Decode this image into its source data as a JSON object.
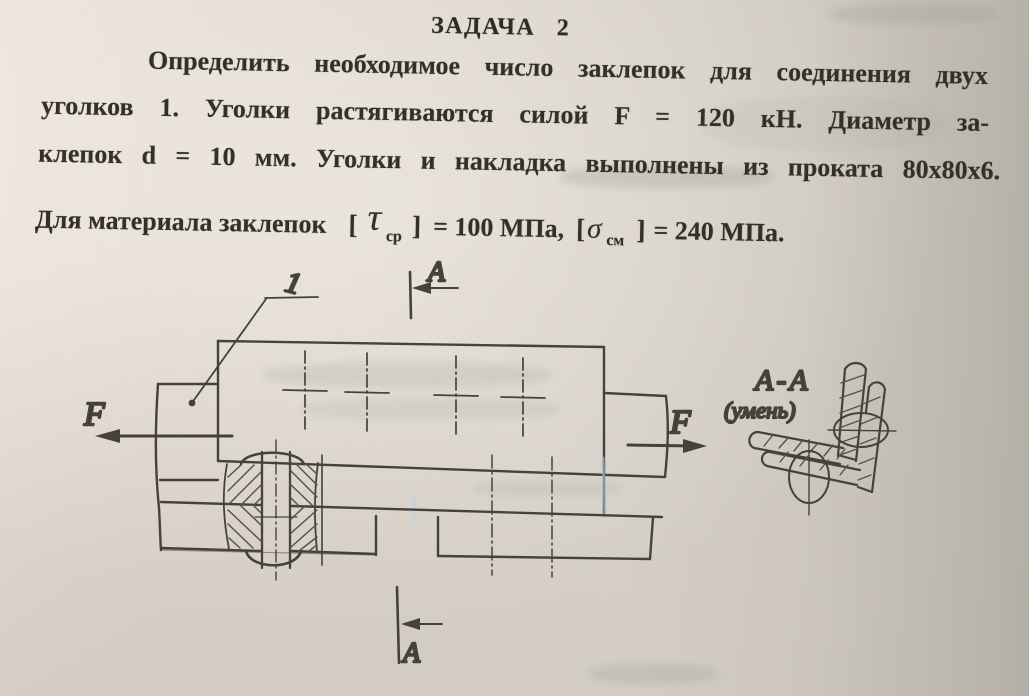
{
  "doc": {
    "title": "ЗАДАЧА 2",
    "lines": [
      "Определить необходимое число заклепок для соединения двух",
      "уголков 1. Уголки растягиваются силой F = 120 кН. Диаметр за-",
      "клепок d = 10 мм. Уголки и накладка выполнены из проката 80х80х6."
    ],
    "formula": {
      "prefix": "Для материала заклепок",
      "open1": "[",
      "tau": "τ",
      "tau_sub": "ср",
      "close1": "]",
      "val1": "= 100 МПа,",
      "open2": "[",
      "sigma": "σ",
      "sigma_sub": "см",
      "close2": "]",
      "val2": "= 240 МПа."
    }
  },
  "figure": {
    "part_label": "1",
    "force_left": "F",
    "force_right": "F",
    "section_top": "A",
    "section_bottom": "A",
    "view_title": "A-A",
    "view_note": "(умень)",
    "colors": {
      "paper": "#d9d2c9",
      "ink": "#3f3b35",
      "blue_artifact": "#9cc3d4"
    }
  }
}
